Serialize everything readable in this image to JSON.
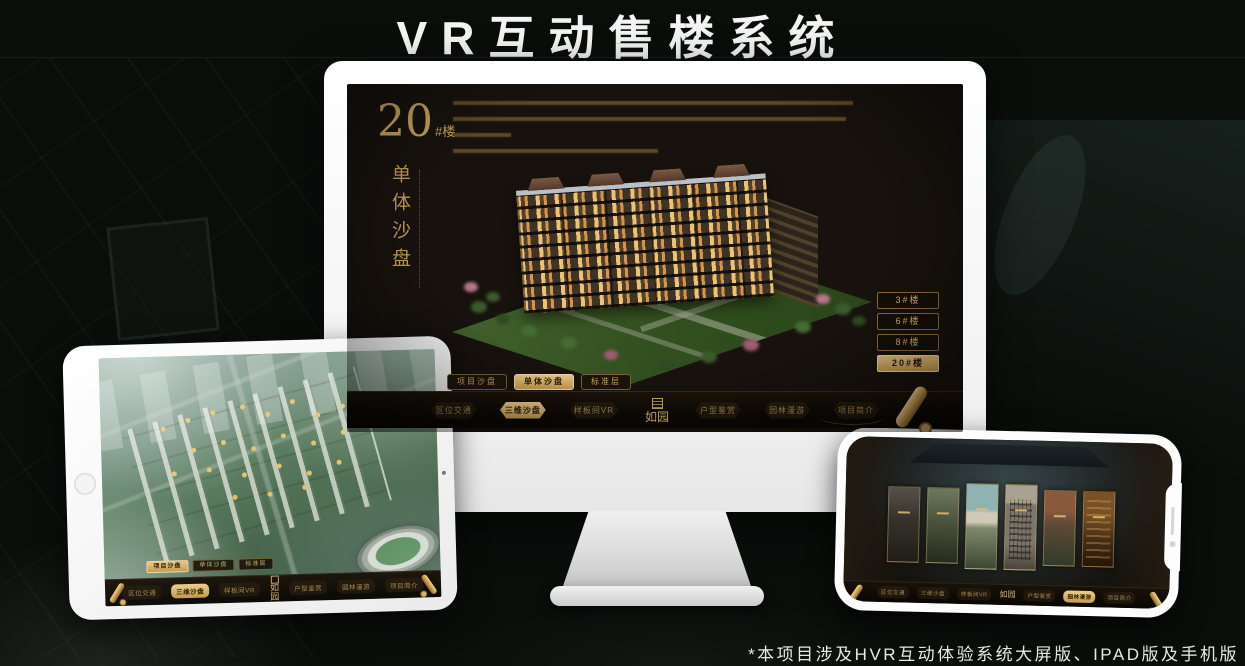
{
  "page": {
    "title": "VR互动售楼系统",
    "footnote": "*本项目涉及HVR互动体验系统大屏版、IPAD版及手机版"
  },
  "colors": {
    "gold": "#c9a45c",
    "gold_active_bg": "#d8b066",
    "screen_bg": "#17120d",
    "navbar_bg": "#0b0704",
    "device_white": "#f6f6f6",
    "page_bg": "#0a0e0b"
  },
  "sales_app": {
    "headline": {
      "number": "20",
      "unit": "#楼",
      "subtitle": "单体沙盘"
    },
    "floor_buttons": [
      {
        "label": "3#楼"
      },
      {
        "label": "6#楼"
      },
      {
        "label": "8#楼"
      },
      {
        "label": "20#楼"
      }
    ],
    "view_tabs": [
      {
        "label": "项目沙盘"
      },
      {
        "label": "单体沙盘"
      },
      {
        "label": "标准层"
      }
    ],
    "nav": {
      "left": [
        {
          "label": "区位交通"
        },
        {
          "label": "三维沙盘"
        },
        {
          "label": "样板间VR"
        }
      ],
      "logo": "如园",
      "right": [
        {
          "label": "户型鉴赏"
        },
        {
          "label": "园林漫游"
        },
        {
          "label": "项目简介"
        }
      ]
    },
    "states": {
      "monitor": {
        "active_tab": "单体沙盘",
        "active_nav": "三维沙盘",
        "active_floor": "20#楼"
      },
      "tablet": {
        "active_tab": "项目沙盘",
        "active_nav": "三维沙盘"
      },
      "phone": {
        "active_nav": "园林漫游"
      }
    }
  }
}
